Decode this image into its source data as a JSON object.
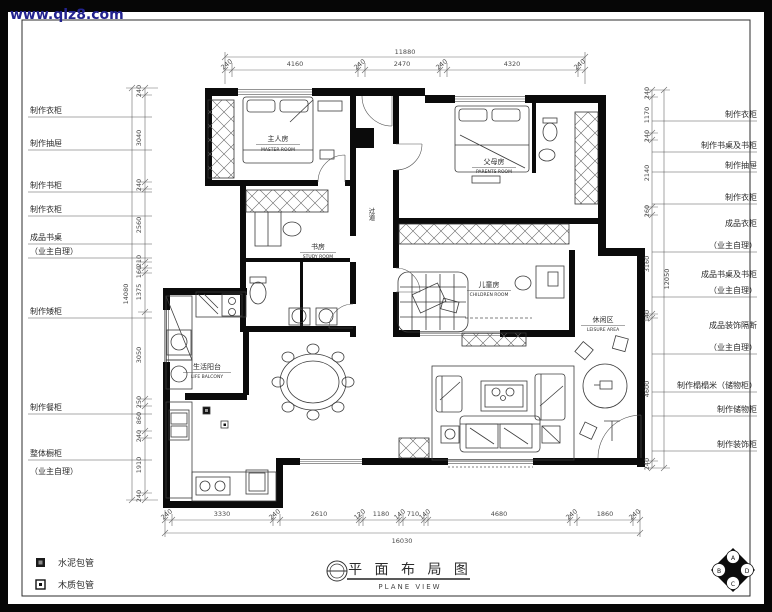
{
  "watermark": "www.qlz8.com",
  "title": {
    "cn": "平 面 布 局 图",
    "en": "PLANE VIEW"
  },
  "legend": {
    "cement": "水泥包管",
    "wood": "木质包管"
  },
  "compass": {
    "a": "A",
    "b": "B",
    "c": "C",
    "d": "D"
  },
  "labels_left": [
    "制作衣柜",
    "制作抽屉",
    "制作书柜",
    "制作衣柜",
    "成品书桌",
    "（业主自理）",
    "制作矮柜",
    "制作餐柜",
    "整体橱柜",
    "（业主自理）"
  ],
  "labels_right": [
    "制作衣柜",
    "制作书桌及书柜",
    "制作抽屉",
    "制作衣柜",
    "成品衣柜",
    "（业主自理）",
    "成品书桌及书柜",
    "（业主自理）",
    "成品装饰隔断",
    "（业主自理）",
    "制作榻榻米（储物柜）",
    "制作储物柜",
    "制作装饰柜"
  ],
  "rooms": {
    "master": {
      "cn": "主人房",
      "en": "MASTER ROOM"
    },
    "study": {
      "cn": "书房",
      "en": "STUDY ROOM"
    },
    "parents": {
      "cn": "父母房",
      "en": "PARENTS ROOM"
    },
    "hallway": {
      "cn": "过道"
    },
    "children": {
      "cn": "儿童房",
      "en": "CHILDREN ROOM"
    },
    "balcony": {
      "cn": "生活阳台",
      "en": "LIFE BALCONY"
    },
    "leisure": {
      "cn": "休闲区",
      "en": "LEISURE AREA"
    }
  },
  "dims": {
    "top_total": "11880",
    "top": [
      "240",
      "4160",
      "240",
      "2470",
      "240",
      "4320",
      "240"
    ],
    "bottom": [
      "240",
      "3330",
      "240",
      "2610",
      "120",
      "1180",
      "140",
      "710",
      "140",
      "4680",
      "240",
      "1860",
      "240"
    ],
    "bottom_total": "16030",
    "left": [
      "240",
      "3040",
      "240",
      "2560",
      "210",
      "160",
      "1375",
      "3050",
      "250",
      "860",
      "240",
      "1910",
      "240"
    ],
    "left_total": "14080",
    "right": [
      "240",
      "1170",
      "240",
      "2140",
      "260",
      "3160",
      "140",
      "4600",
      "240"
    ],
    "right_total": "12050"
  }
}
